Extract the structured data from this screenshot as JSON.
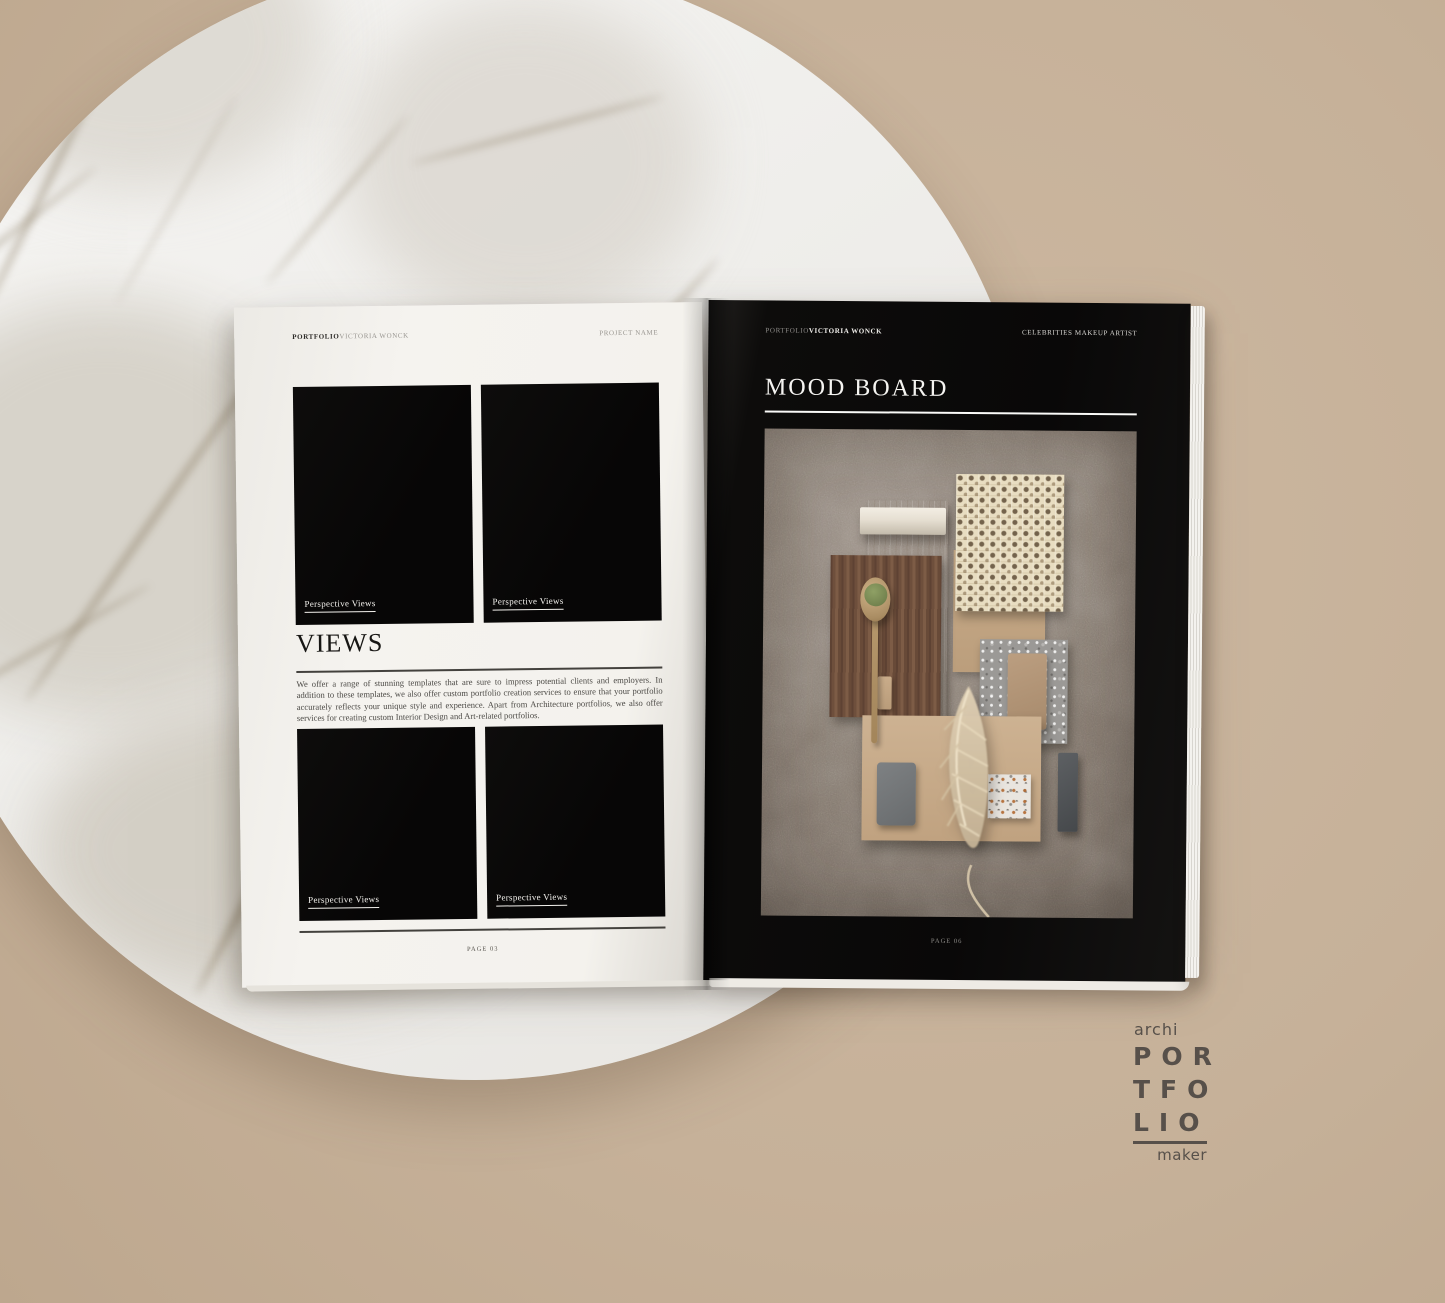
{
  "left_page": {
    "header": {
      "brand_bold": "PORTFOLIO",
      "brand_light": "VICTORIA WONCK",
      "project_label": "PROJECT NAME"
    },
    "section_title": "VIEWS",
    "body_text": "We offer a range of stunning templates that are sure to impress potential clients and employers. In addition to these templates, we also offer custom portfolio creation services to ensure that your portfolio accurately reflects your unique style and experience.  Apart from Architecture portfolios, we also offer services for creating custom Interior Design and Art-related portfolios.",
    "figures": [
      {
        "label": "Perspective Views"
      },
      {
        "label": "Perspective Views"
      },
      {
        "label": "Perspective Views"
      },
      {
        "label": "Perspective Views"
      }
    ],
    "page_number": "PAGE 03"
  },
  "right_page": {
    "header": {
      "brand_light": "PORTFOLIO",
      "brand_bold": "VICTORIA WONCK",
      "project_label": "CELEBRITIES MAKEUP ARTIST"
    },
    "section_title": "MOOD BOARD",
    "page_number": "PAGE 06",
    "moodboard_materials": [
      "concrete backdrop",
      "white marble trim",
      "oak laminate panels",
      "rattan cane webbing",
      "walnut wood board",
      "wooden spoon with matcha powder",
      "gray terrazzo sample",
      "white terrazzo sample",
      "beige laminate swatches",
      "gray laminate swatch",
      "charcoal laminate bar",
      "dried pampas plume"
    ]
  },
  "brand_logo": {
    "top_word": "archi",
    "lines": [
      "POR",
      "TFO",
      "LIO"
    ],
    "bottom_word": "maker"
  },
  "palette": {
    "backdrop": "#c7b29b",
    "page_white": "#f3f1ec",
    "page_black": "#0b0a09",
    "concrete": "#857a70",
    "oak": "#c9ae8e",
    "walnut": "#6e4f3c",
    "rattan": "#e8ddc1",
    "logo_text": "#57504a"
  }
}
